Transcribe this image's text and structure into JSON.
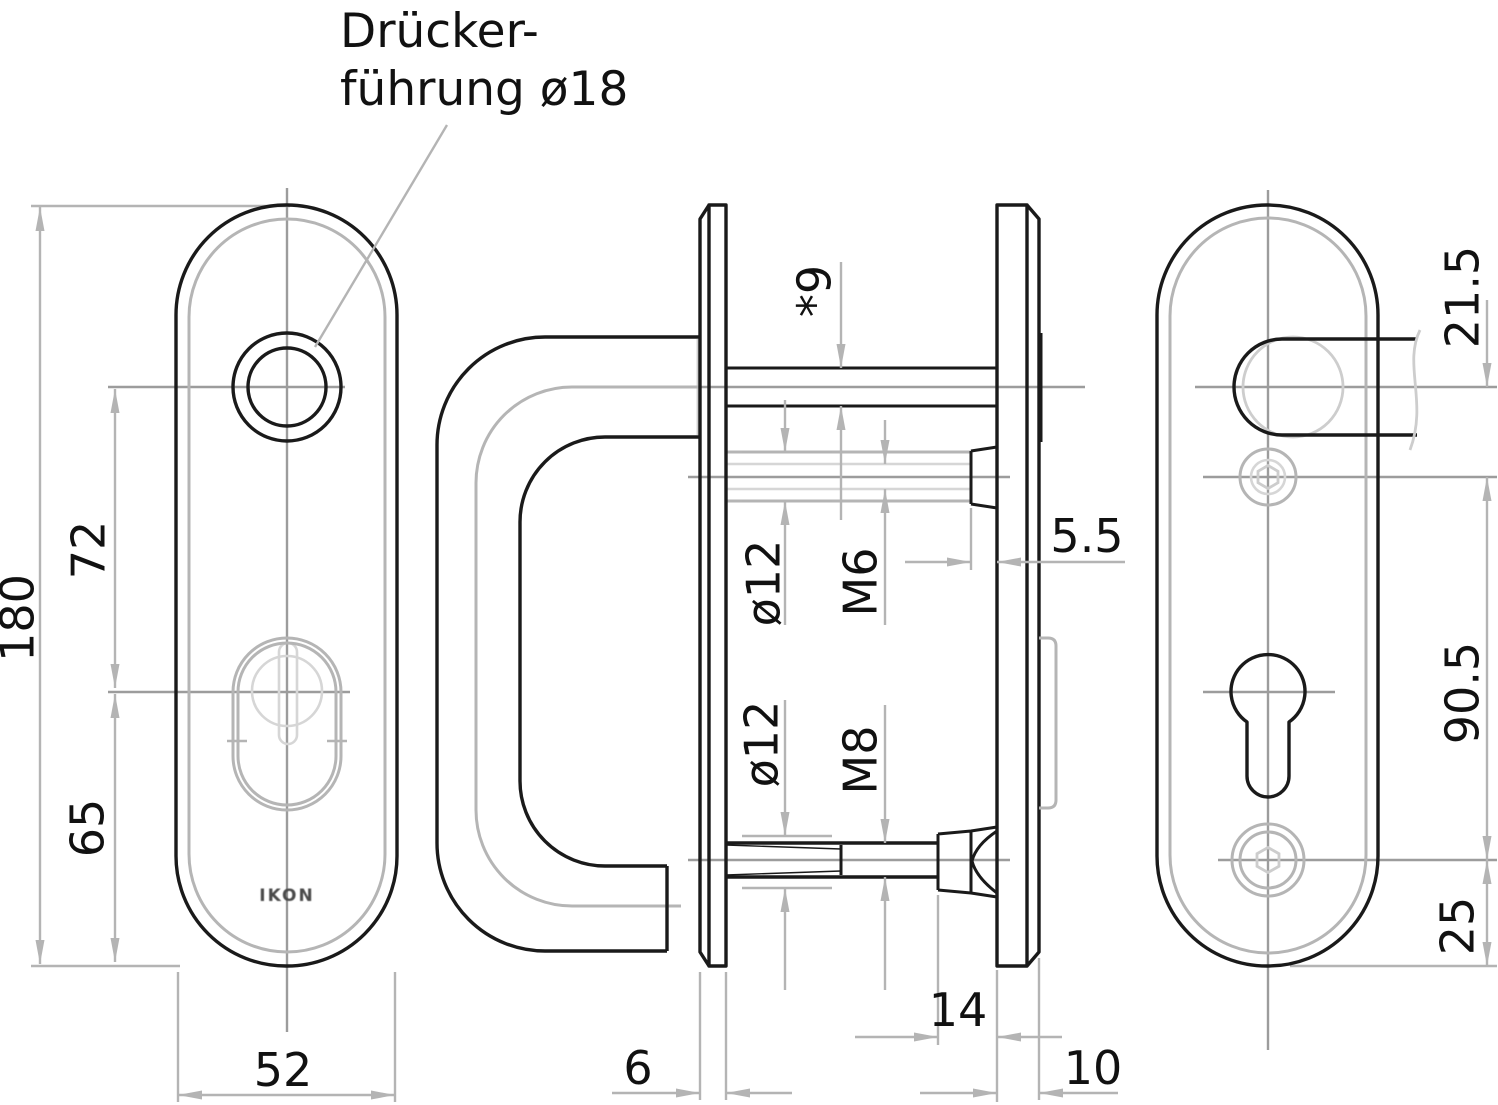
{
  "drawing": {
    "title_annotation": {
      "line1": "Drücker-",
      "line2": "führung ø18"
    },
    "logo_text": "IKON",
    "dimensions": {
      "plate_height": "180",
      "handle_to_cylinder": "72",
      "cylinder_to_bottom": "65",
      "plate_width": "52",
      "spindle_square": "*9",
      "sleeve_dia_top": "ø12",
      "screw_top": "M6",
      "head_depth": "5.5",
      "sleeve_dia_bottom": "ø12",
      "screw_bottom": "M8",
      "nut_length": "14",
      "front_plate_thickness": "6",
      "back_plate_thickness": "10",
      "handle_to_screw": "21.5",
      "screw_spacing": "90.5",
      "screw_to_bottom": "25"
    },
    "colors": {
      "outline": "#1a1a1a",
      "dimension_lines": "#b4b4b4",
      "centerlines": "#9c9c9c",
      "light_detail": "#cdcdcd",
      "text": "#111111",
      "background": "#ffffff"
    }
  }
}
